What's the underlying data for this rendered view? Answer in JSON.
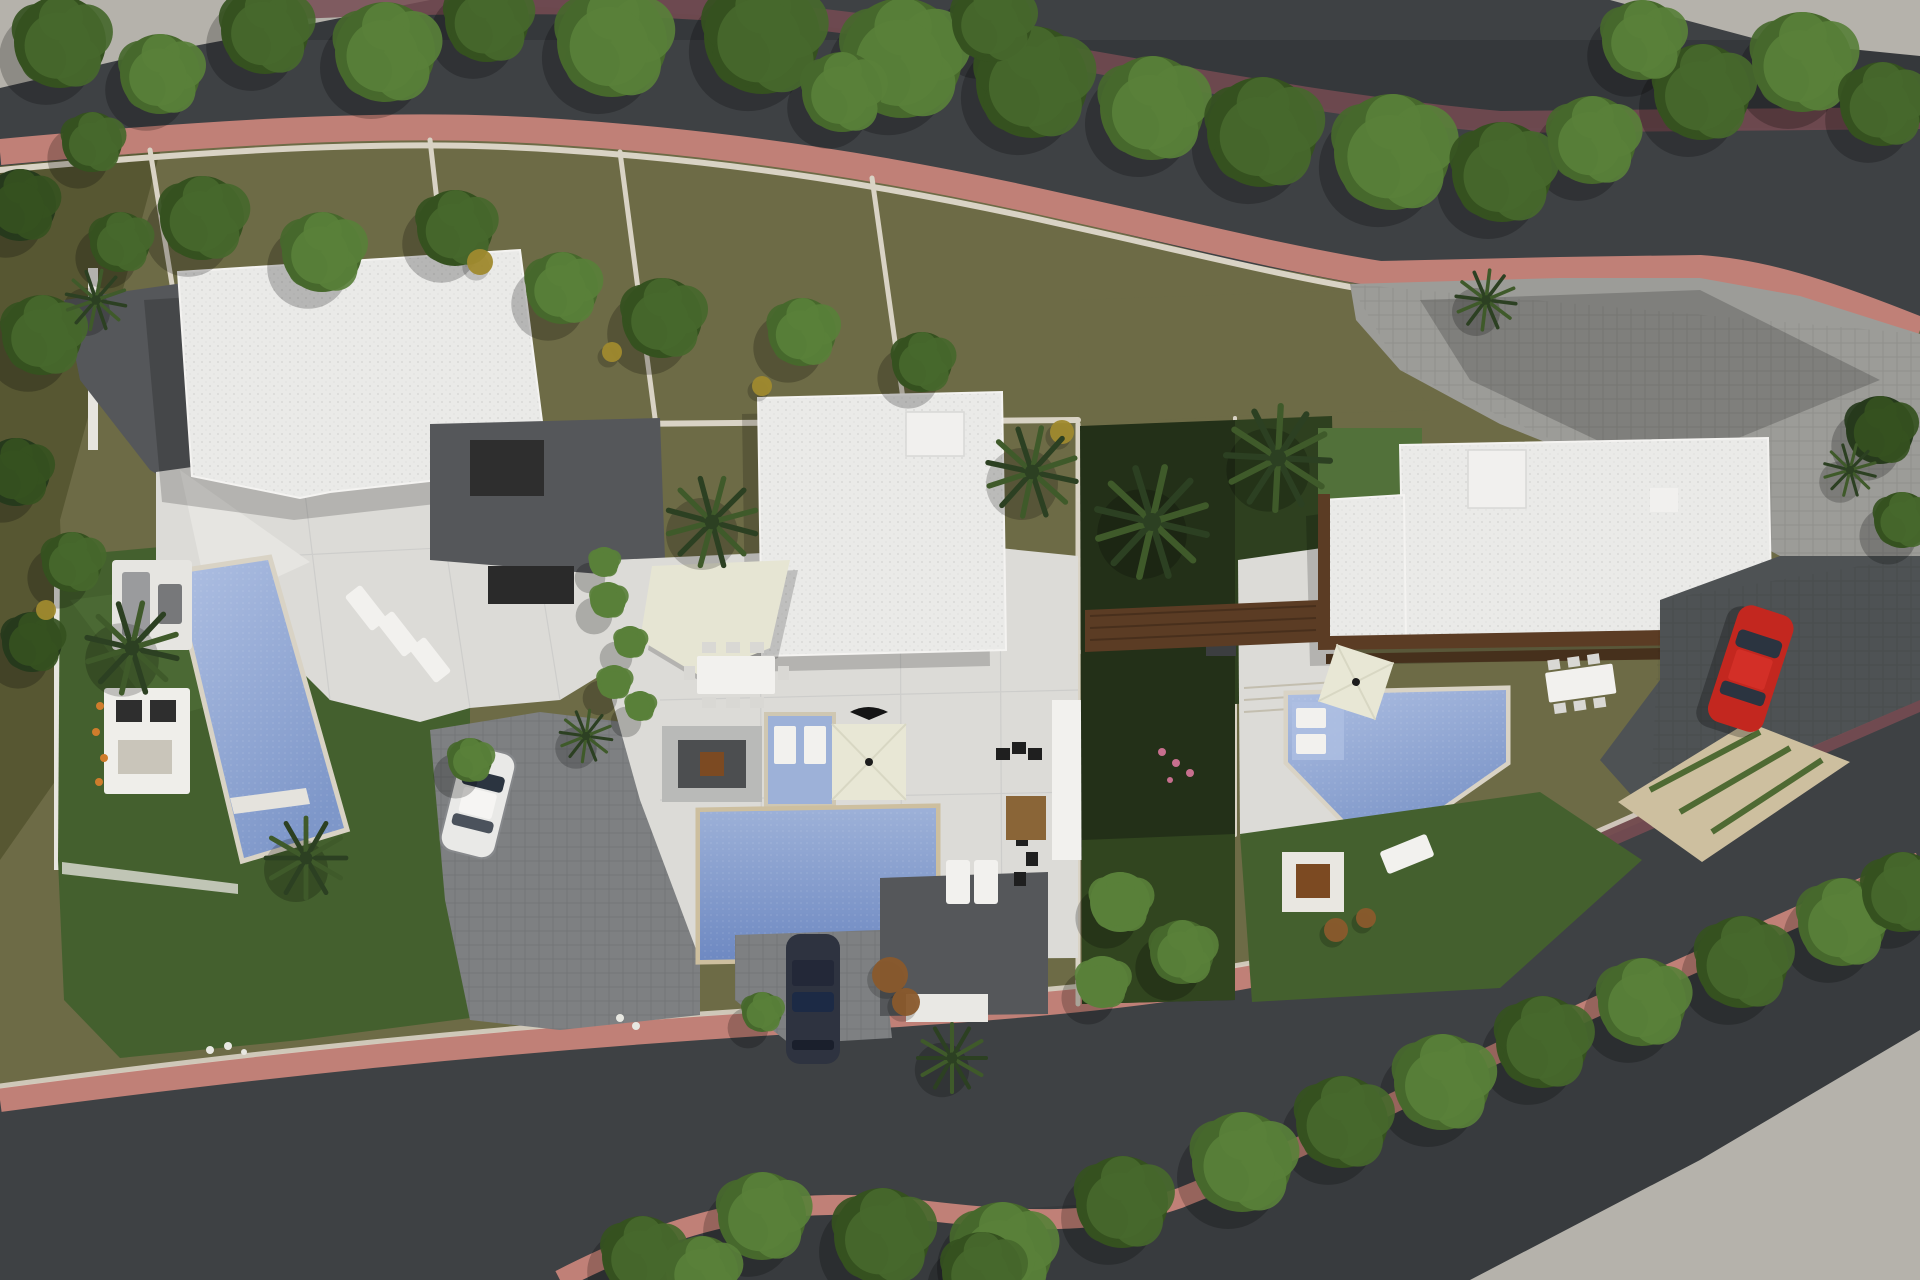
{
  "meta": {
    "title": "Aerial 3D render — site plan of three modern villas with pools",
    "scene_type": "architectural aerial render, top-down",
    "canvas": {
      "width": 1920,
      "height": 1280
    }
  },
  "colors": {
    "asphalt": "#3e4144",
    "asphalt_shade": "#33363a",
    "pavement": "#b5b2ab",
    "sidewalk_pink": "#c08077",
    "sidewalk_mauve": "#754b52",
    "wall_stone": "#d9d3c5",
    "wall_tan": "#cdbf9f",
    "ground_olive": "#6d6b46",
    "ground_olive_dark": "#54532f",
    "lawn": "#44602e",
    "lawn_light": "#52713a",
    "garden_dark": "#233018",
    "hedge_green": "#5f8040",
    "roof_white": "#eaeae8",
    "roof_bright": "#f1f0ee",
    "terrace_white": "#dcdbd7",
    "terrace_light": "#e6e5e1",
    "court_dark": "#55575a",
    "paver_gray": "#7e8082",
    "paver_mid": "#9c9c98",
    "paver_dark": "#4e5254",
    "pool_light": "#aebfe2",
    "pool_mid": "#8ba3d4",
    "pool_deep": "#6e89c2",
    "spa_blue": "#9db1d8",
    "sail_cream": "#e6e5d3",
    "umbrella_cream": "#e8e7d5",
    "wood_brown": "#5b3c24",
    "wood_dark": "#46301c",
    "rug_brown": "#8a6537",
    "firepit_brown": "#7c4a22",
    "kitchen_black": "#2e2e2e",
    "car_red": "#c3271f",
    "car_white": "#e9e9e7",
    "car_dark": "#2e3340",
    "glass_dark": "#2b3440",
    "furn_gray": "#9a9b9d",
    "furn_white": "#f2f1ee",
    "tree_dark": "#263a1c",
    "tree_mid": "#35511f",
    "tree_light": "#47682c",
    "tree_bright": "#59803a",
    "shrub_yellow": "#a08a2e",
    "palm_dark": "#2c4022",
    "palm_mid": "#3f5a2a",
    "flower_orange": "#cf7c2c",
    "flower_pink": "#c76f8e",
    "flower_white": "#e8e8e2",
    "shrub_rust": "#8a5a2c"
  },
  "objects": {
    "roads": [
      "upper curved street",
      "lower curved street"
    ],
    "sidewalks": [
      "pink paved walk upper street",
      "pink paved walk lower street",
      "shaded mauve walks under trees"
    ],
    "villas": [
      {
        "id": "villa-1",
        "features": [
          "white flat roof",
          "terrace with lounge set",
          "slanted pool",
          "three sun loungers",
          "outdoor kitchen",
          "lawn with palms",
          "paver driveway",
          "white car"
        ]
      },
      {
        "id": "villa-2",
        "features": [
          "white flat roof with skylight box",
          "shade sail",
          "outdoor dining table",
          "fire-pit lounge",
          "raised spa with sun pads",
          "square cream parasol",
          "large pool",
          "driveway with dark car",
          "entry court"
        ]
      },
      {
        "id": "villa-3",
        "features": [
          "large white flat roof",
          "timber deck band",
          "angular pool with swim-out pads",
          "cream parasol",
          "outdoor dining table",
          "lawn with fire pit and lounger",
          "stone path with grass joints",
          "dark paver driveway",
          "red car",
          "paver parking"
        ]
      }
    ],
    "vehicles": [
      "white car villa-1",
      "dark car villa-2",
      "red car villa-3"
    ]
  },
  "vegetation": {
    "tree_clusters": [
      {
        "x": 60,
        "y": 42,
        "r": 46,
        "c": 1
      },
      {
        "x": 160,
        "y": 74,
        "r": 40,
        "c": 2
      },
      {
        "x": 265,
        "y": 30,
        "r": 44,
        "c": 1
      },
      {
        "x": 385,
        "y": 52,
        "r": 50,
        "c": 2
      },
      {
        "x": 487,
        "y": 20,
        "r": 42,
        "c": 1
      },
      {
        "x": 612,
        "y": 42,
        "r": 55,
        "c": 2
      },
      {
        "x": 762,
        "y": 36,
        "r": 58,
        "c": 1
      },
      {
        "x": 902,
        "y": 58,
        "r": 60,
        "c": 2
      },
      {
        "x": 1032,
        "y": 82,
        "r": 56,
        "c": 1
      },
      {
        "x": 1152,
        "y": 108,
        "r": 52,
        "c": 2
      },
      {
        "x": 1262,
        "y": 132,
        "r": 55,
        "c": 1
      },
      {
        "x": 1392,
        "y": 152,
        "r": 58,
        "c": 2
      },
      {
        "x": 1502,
        "y": 172,
        "r": 50,
        "c": 1
      },
      {
        "x": 1592,
        "y": 140,
        "r": 44,
        "c": 2
      },
      {
        "x": 1702,
        "y": 92,
        "r": 48,
        "c": 1
      },
      {
        "x": 1802,
        "y": 62,
        "r": 50,
        "c": 2
      },
      {
        "x": 1882,
        "y": 104,
        "r": 42,
        "c": 1
      },
      {
        "x": 1642,
        "y": 40,
        "r": 40,
        "c": 2
      },
      {
        "x": 842,
        "y": 92,
        "r": 40,
        "c": 2
      },
      {
        "x": 992,
        "y": 22,
        "r": 40,
        "c": 1
      },
      {
        "x": 202,
        "y": 218,
        "r": 42,
        "c": 1
      },
      {
        "x": 322,
        "y": 252,
        "r": 40,
        "c": 2
      },
      {
        "x": 455,
        "y": 228,
        "r": 38,
        "c": 1
      },
      {
        "x": 562,
        "y": 288,
        "r": 36,
        "c": 2
      },
      {
        "x": 662,
        "y": 318,
        "r": 40,
        "c": 1
      },
      {
        "x": 802,
        "y": 332,
        "r": 34,
        "c": 2
      },
      {
        "x": 922,
        "y": 362,
        "r": 30,
        "c": 1
      },
      {
        "x": 120,
        "y": 242,
        "r": 30,
        "c": 1
      },
      {
        "x": 20,
        "y": 205,
        "r": 36,
        "c": 0
      },
      {
        "x": 42,
        "y": 335,
        "r": 40,
        "c": 1
      },
      {
        "x": 16,
        "y": 472,
        "r": 34,
        "c": 0
      },
      {
        "x": 72,
        "y": 562,
        "r": 30,
        "c": 1
      },
      {
        "x": 32,
        "y": 642,
        "r": 30,
        "c": 0
      },
      {
        "x": 92,
        "y": 142,
        "r": 30,
        "c": 1
      },
      {
        "x": 608,
        "y": 600,
        "r": 18,
        "c": 3
      },
      {
        "x": 630,
        "y": 642,
        "r": 16,
        "c": 3
      },
      {
        "x": 614,
        "y": 682,
        "r": 17,
        "c": 3
      },
      {
        "x": 640,
        "y": 706,
        "r": 15,
        "c": 3
      },
      {
        "x": 604,
        "y": 562,
        "r": 15,
        "c": 3
      },
      {
        "x": 1120,
        "y": 902,
        "r": 30,
        "c": 3
      },
      {
        "x": 1182,
        "y": 952,
        "r": 32,
        "c": 2
      },
      {
        "x": 1102,
        "y": 982,
        "r": 26,
        "c": 3
      },
      {
        "x": 762,
        "y": 1012,
        "r": 20,
        "c": 2
      },
      {
        "x": 470,
        "y": 760,
        "r": 22,
        "c": 2
      },
      {
        "x": 642,
        "y": 1256,
        "r": 40,
        "c": 1
      },
      {
        "x": 762,
        "y": 1216,
        "r": 44,
        "c": 2
      },
      {
        "x": 882,
        "y": 1236,
        "r": 48,
        "c": 1
      },
      {
        "x": 1002,
        "y": 1252,
        "r": 50,
        "c": 2
      },
      {
        "x": 1122,
        "y": 1202,
        "r": 46,
        "c": 1
      },
      {
        "x": 1242,
        "y": 1162,
        "r": 50,
        "c": 2
      },
      {
        "x": 1342,
        "y": 1122,
        "r": 46,
        "c": 1
      },
      {
        "x": 1442,
        "y": 1082,
        "r": 48,
        "c": 2
      },
      {
        "x": 1542,
        "y": 1042,
        "r": 46,
        "c": 1
      },
      {
        "x": 1642,
        "y": 1002,
        "r": 44,
        "c": 2
      },
      {
        "x": 1742,
        "y": 962,
        "r": 46,
        "c": 1
      },
      {
        "x": 1842,
        "y": 922,
        "r": 44,
        "c": 2
      },
      {
        "x": 1902,
        "y": 892,
        "r": 40,
        "c": 1
      },
      {
        "x": 702,
        "y": 1272,
        "r": 36,
        "c": 2
      },
      {
        "x": 982,
        "y": 1272,
        "r": 40,
        "c": 1
      },
      {
        "x": 1880,
        "y": 430,
        "r": 34,
        "c": 0
      },
      {
        "x": 1902,
        "y": 520,
        "r": 28,
        "c": 1
      }
    ],
    "shrub_dots": [
      {
        "x": 480,
        "y": 262,
        "r": 13,
        "color": "shrub_yellow"
      },
      {
        "x": 612,
        "y": 352,
        "r": 10,
        "color": "shrub_yellow"
      },
      {
        "x": 762,
        "y": 386,
        "r": 10,
        "color": "shrub_yellow"
      },
      {
        "x": 1062,
        "y": 432,
        "r": 12,
        "color": "shrub_yellow"
      },
      {
        "x": 46,
        "y": 610,
        "r": 10,
        "color": "shrub_yellow"
      },
      {
        "x": 890,
        "y": 975,
        "r": 18,
        "color": "shrub_rust"
      },
      {
        "x": 906,
        "y": 1002,
        "r": 14,
        "color": "shrub_rust"
      },
      {
        "x": 1336,
        "y": 930,
        "r": 12,
        "color": "shrub_rust"
      },
      {
        "x": 1366,
        "y": 918,
        "r": 10,
        "color": "shrub_rust"
      }
    ],
    "palms": [
      {
        "x": 132,
        "y": 648,
        "r": 46
      },
      {
        "x": 306,
        "y": 858,
        "r": 40
      },
      {
        "x": 712,
        "y": 522,
        "r": 45
      },
      {
        "x": 1032,
        "y": 472,
        "r": 45
      },
      {
        "x": 1152,
        "y": 522,
        "r": 56
      },
      {
        "x": 1278,
        "y": 458,
        "r": 52
      },
      {
        "x": 586,
        "y": 736,
        "r": 26
      },
      {
        "x": 96,
        "y": 300,
        "r": 30
      },
      {
        "x": 952,
        "y": 1058,
        "r": 34
      },
      {
        "x": 1486,
        "y": 300,
        "r": 30
      },
      {
        "x": 1850,
        "y": 470,
        "r": 26
      }
    ],
    "flowers": [
      {
        "x": 100,
        "y": 706,
        "r": 4,
        "color": "flower_orange"
      },
      {
        "x": 96,
        "y": 732,
        "r": 4,
        "color": "flower_orange"
      },
      {
        "x": 104,
        "y": 758,
        "r": 4,
        "color": "flower_orange"
      },
      {
        "x": 99,
        "y": 782,
        "r": 4,
        "color": "flower_orange"
      },
      {
        "x": 1162,
        "y": 752,
        "r": 4,
        "color": "flower_pink"
      },
      {
        "x": 1176,
        "y": 763,
        "r": 4,
        "color": "flower_pink"
      },
      {
        "x": 1190,
        "y": 773,
        "r": 4,
        "color": "flower_pink"
      },
      {
        "x": 1170,
        "y": 780,
        "r": 3,
        "color": "flower_pink"
      },
      {
        "x": 210,
        "y": 1050,
        "r": 4,
        "color": "flower_white"
      },
      {
        "x": 228,
        "y": 1046,
        "r": 4,
        "color": "flower_white"
      },
      {
        "x": 244,
        "y": 1052,
        "r": 3,
        "color": "flower_white"
      },
      {
        "x": 620,
        "y": 1018,
        "r": 4,
        "color": "flower_white"
      },
      {
        "x": 636,
        "y": 1026,
        "r": 4,
        "color": "flower_white"
      }
    ]
  }
}
